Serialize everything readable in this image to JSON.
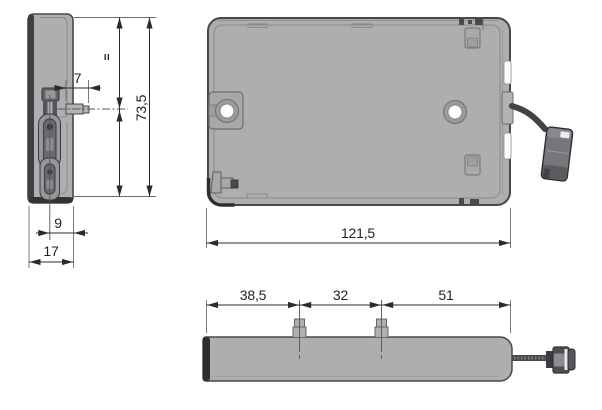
{
  "dimensions": {
    "side_view": {
      "tab_protrusion": "7",
      "equal_spacing_symbol": "=",
      "overall_height": "73,5",
      "mechanism_offset": "9",
      "overall_depth": "17"
    },
    "front_view": {
      "overall_width": "121,5"
    },
    "bottom_view": {
      "left_tab_from_edge": "38,5",
      "tab_spacing": "32",
      "right_tab_to_edge": "51"
    }
  },
  "colors": {
    "background": "#ffffff",
    "body_fill": "#aeaeb0",
    "body_stroke": "#48484a",
    "dark_detail": "#3c3c40",
    "dimension_line": "#2b2b2b",
    "extension_line": "#6b6b6f",
    "hole_fill": "#ffffff"
  }
}
